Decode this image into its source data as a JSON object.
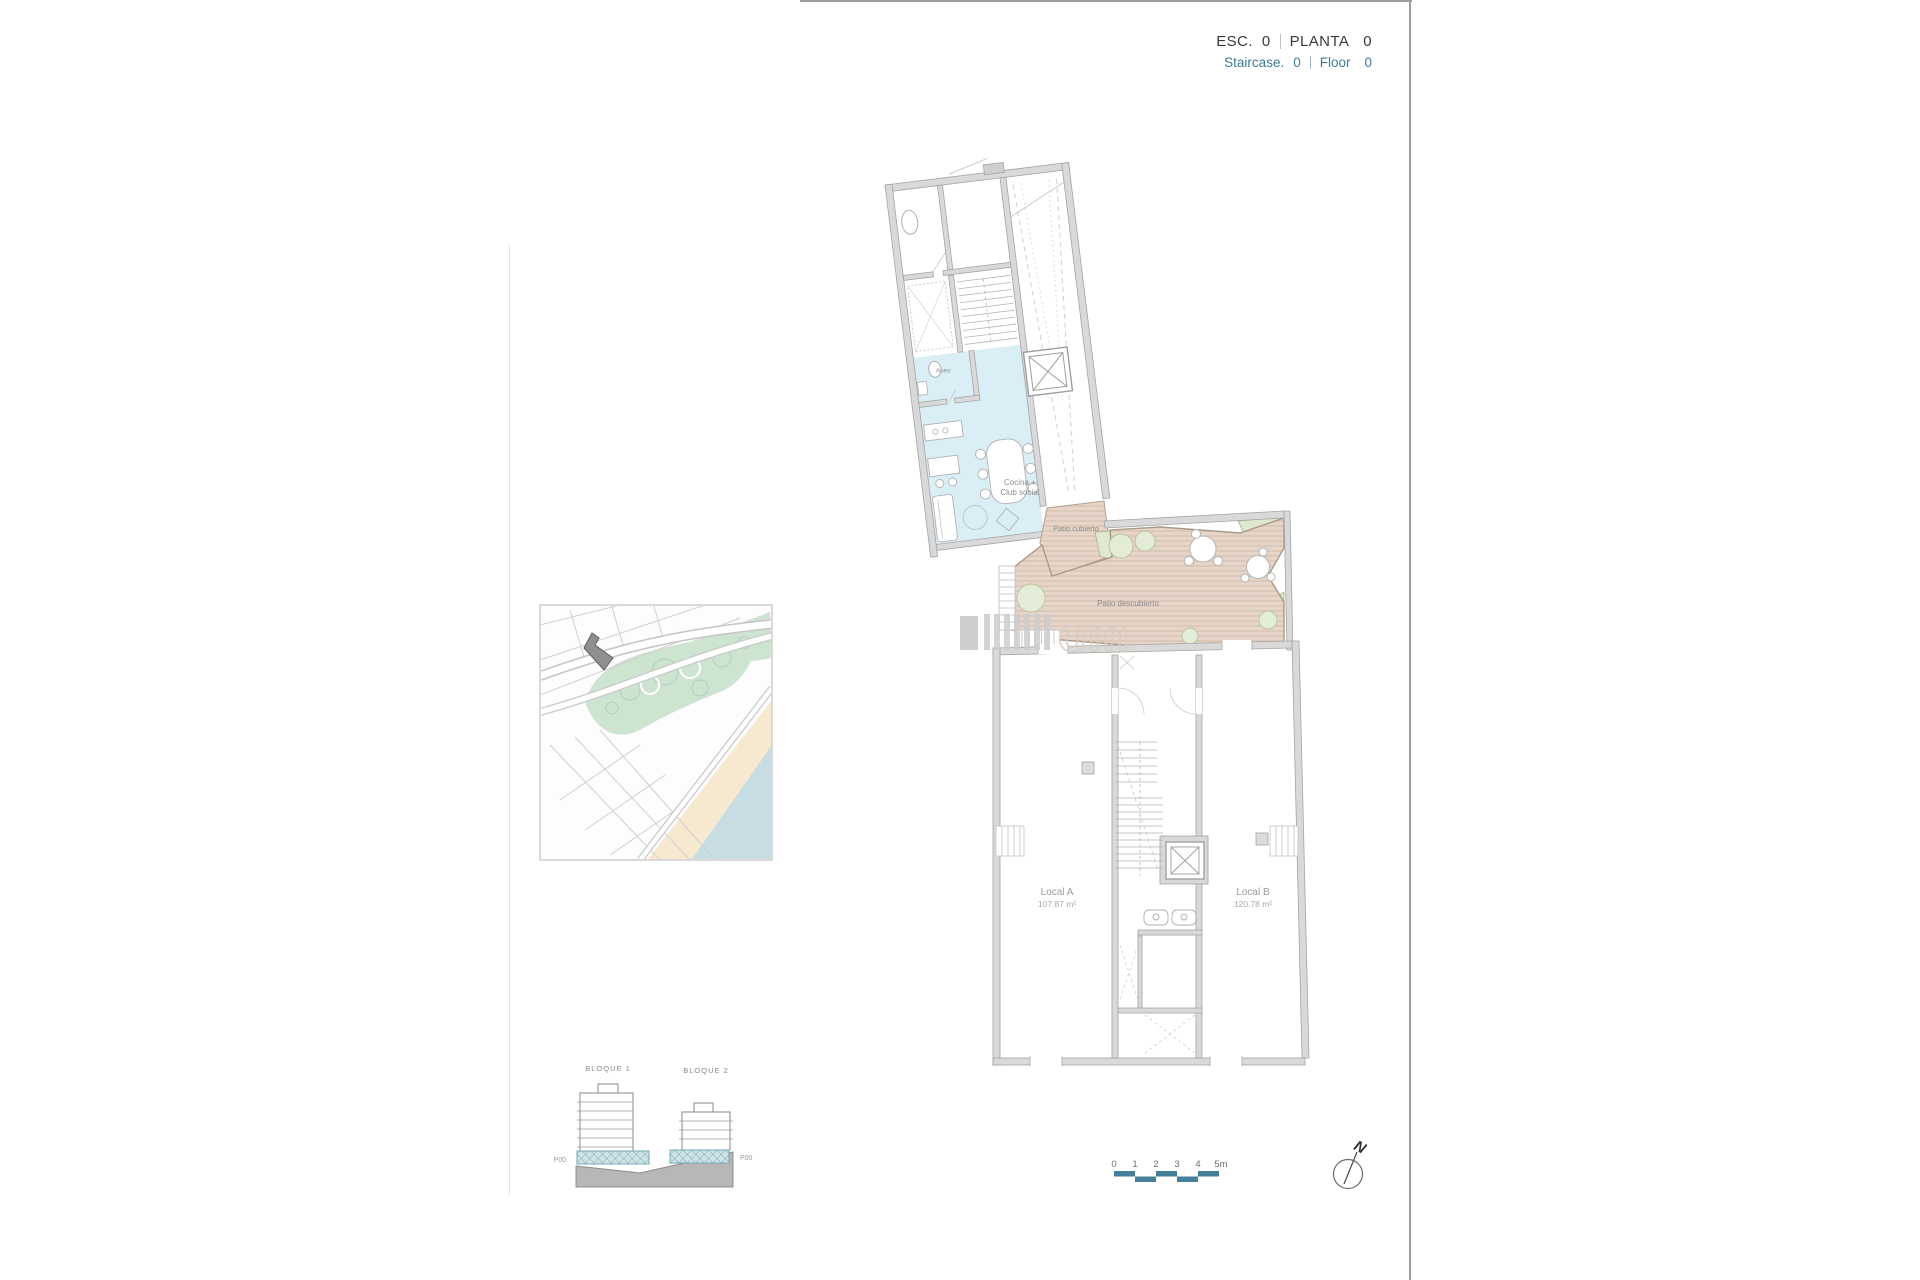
{
  "header": {
    "esc_label": "ESC.",
    "esc_value": "0",
    "planta_label": "PLANTA",
    "planta_value": "0",
    "staircase_label": "Staircase.",
    "staircase_value": "0",
    "floor_label": "Floor",
    "floor_value": "0"
  },
  "plan": {
    "aseo_label": "Aseo",
    "cocina_line1": "Cocina +",
    "cocina_line2": "Club social",
    "patio_cubierto_label": "Patio cubierto",
    "patio_descubierto_label": "Patio descubierto",
    "local_a_name": "Local A",
    "local_a_area": "107.87 m²",
    "local_b_name": "Local B",
    "local_b_area": "120.78 m²"
  },
  "elevation": {
    "bloque1_label": "BLOQUE 1",
    "bloque2_label": "BLOQUE 2",
    "left_level_label": "P00",
    "right_level_label": "P00"
  },
  "scale_bar": {
    "ticks": [
      "0",
      "1",
      "2",
      "3",
      "4",
      "5m"
    ]
  },
  "compass": {
    "north_label": "N"
  },
  "watermark": {
    "text": "om"
  },
  "colors": {
    "accent_teal": "#3E7D98",
    "scalebar_teal": "#44809B",
    "room_blue": "#DAEEF5",
    "patio_tan": "#E4D3C6",
    "garden_green": "#DFE9D0",
    "wall_gray": "#D9D9D9",
    "map_park_green": "#CDE4D1",
    "map_beach": "#F6E9CF",
    "map_sea": "#C8DDE3"
  }
}
